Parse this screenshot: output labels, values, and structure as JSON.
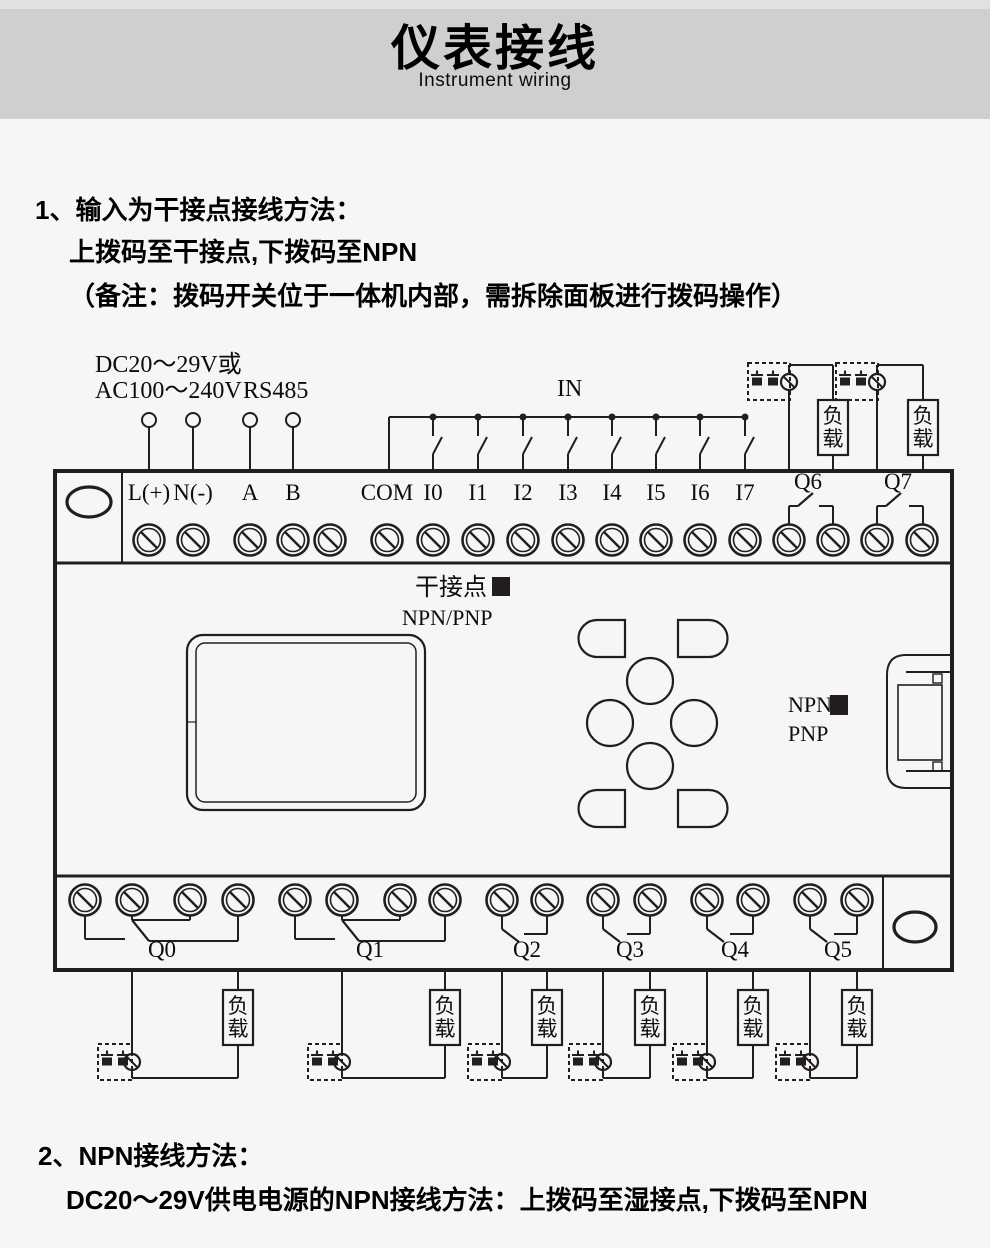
{
  "header": {
    "title": "仪表接线",
    "subtitle": "Instrument wiring"
  },
  "section1": {
    "line1": "1、输入为干接点接线方法：",
    "line2": "上拨码至干接点,下拨码至NPN",
    "line3": "（备注：拨码开关位于一体机内部，需拆除面板进行拨码操作）"
  },
  "section2": {
    "line1": "2、NPN接线方法：",
    "line2": "DC20～29V供电电源的NPN接线方法：上拨码至湿接点,下拨码至NPN"
  },
  "diagram": {
    "power_label_line1": "DC20～29V或",
    "power_label_line2": "AC100～240V",
    "rs485_label": "RS485",
    "in_label": "IN",
    "load_label": "负载",
    "dry_contact_label": "干接点",
    "npn_pnp_label": "NPN/PNP",
    "npn_label": "NPN",
    "pnp_label": "PNP",
    "top_terminal_labels": [
      "L(+)",
      "N(-)",
      "A",
      "B",
      "COM",
      "I0",
      "I1",
      "I2",
      "I3",
      "I4",
      "I5",
      "I6",
      "I7"
    ],
    "top_output_labels": [
      "Q6",
      "Q7"
    ],
    "bottom_output_labels": [
      "Q0",
      "Q1",
      "Q2",
      "Q3",
      "Q4",
      "Q5"
    ],
    "colors": {
      "line": "#221e1f",
      "page_bg": "#f7f6f7",
      "header_bg": "#d0cfd0",
      "text": "#000000"
    }
  }
}
